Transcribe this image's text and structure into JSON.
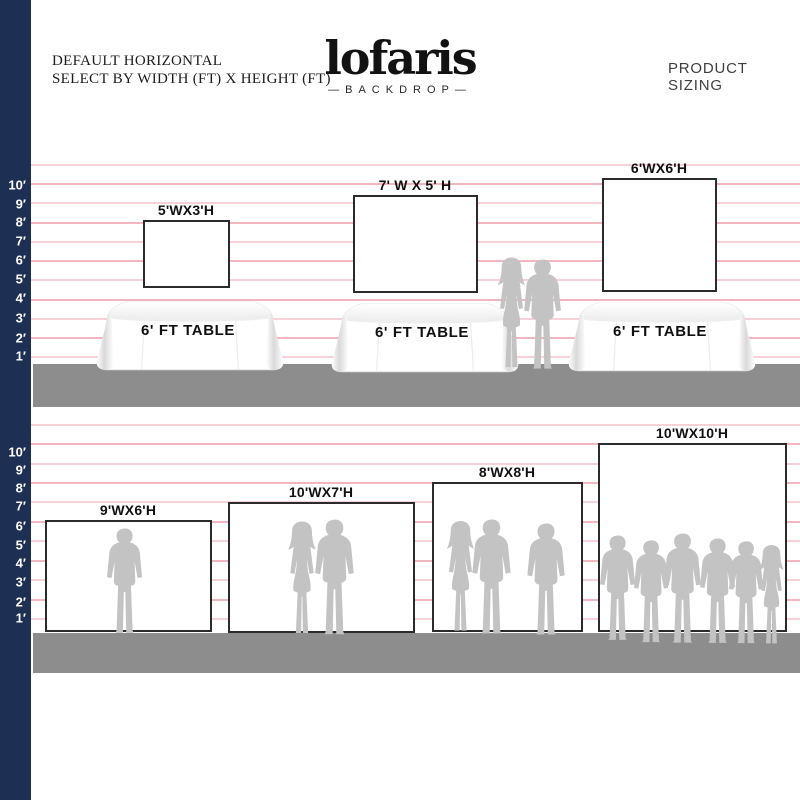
{
  "header": {
    "left_line1": "DEFAULT HORIZONTAL",
    "left_line2": "SELECT BY WIDTH (FT) X HEIGHT (FT)",
    "logo_text": "lofaris",
    "logo_sub": "—BACKDROP—",
    "right_title": "PRODUCT SIZING"
  },
  "scale": {
    "unit": "ft",
    "labels": [
      "10′",
      "9′",
      "8′",
      "7′",
      "6′",
      "5′",
      "4′",
      "3′",
      "2′",
      "1′"
    ]
  },
  "sections": {
    "top": {
      "backdrops": [
        {
          "label": "5'WX3'H",
          "width_ft": 5,
          "height_ft": 3
        },
        {
          "label": "7' W X 5' H",
          "width_ft": 7,
          "height_ft": 5
        },
        {
          "label": "6'WX6'H",
          "width_ft": 6,
          "height_ft": 6
        }
      ],
      "table_label": "6' FT TABLE"
    },
    "bottom": {
      "backdrops": [
        {
          "label": "9'WX6'H",
          "width_ft": 9,
          "height_ft": 6
        },
        {
          "label": "10'WX7'H",
          "width_ft": 10,
          "height_ft": 7
        },
        {
          "label": "8'WX8'H",
          "width_ft": 8,
          "height_ft": 8
        },
        {
          "label": "10'WX10'H",
          "width_ft": 10,
          "height_ft": 10
        }
      ]
    }
  },
  "colors": {
    "sidebar_navy": "#1e2f54",
    "ruled_line_pink": "#ec9aa6",
    "floor_gray": "#8d8d8d",
    "silhouette_gray": "#c3c3c3",
    "backdrop_border": "#2b2b2b"
  }
}
